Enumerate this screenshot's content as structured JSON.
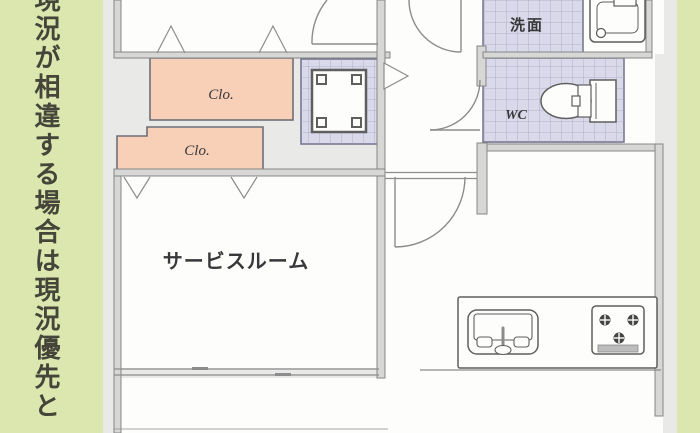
{
  "sidebar": {
    "vertical_text": "現況が相違する場合は現況優先と"
  },
  "floor_plan": {
    "rooms": {
      "service_room": {
        "label": "サービスルーム"
      },
      "washroom": {
        "label": "洗面"
      },
      "toilet_room": {
        "label": "WC"
      },
      "closet_upper": {
        "label": "Clo."
      },
      "closet_lower": {
        "label": "Clo."
      }
    },
    "fixtures": {
      "pipe_space": "pipe-space-unit",
      "toilet": "toilet-icon",
      "washbasin": "washbasin-icon",
      "kitchen_sink": "kitchen-sink-icon",
      "gas_stove": "gas-stove-icon",
      "door_arcs": "door-swing-arc",
      "folding_door_marks": "folding-door-mark",
      "opening_arrow": "opening-arrow-mark",
      "window": "window-symbol"
    },
    "colors": {
      "sidebar_green": "#dbe7ae",
      "sidebar_text": "#45453a",
      "plan_bg": "#e9e9e7",
      "room_white": "#fdfdfc",
      "wall_fill": "#d7d7d5",
      "wall_line": "#868686",
      "line_gray": "#8c8c8c",
      "closet_fill": "#f8cfb7",
      "closet_line": "#6f6f78",
      "tile_fill": "#d9d9ea",
      "tile_line": "#a6a6c2",
      "tile_border": "#71718c",
      "fixture_line": "#5f5f5f",
      "fixture_dark": "#454545",
      "text_dark": "#38383a"
    }
  }
}
